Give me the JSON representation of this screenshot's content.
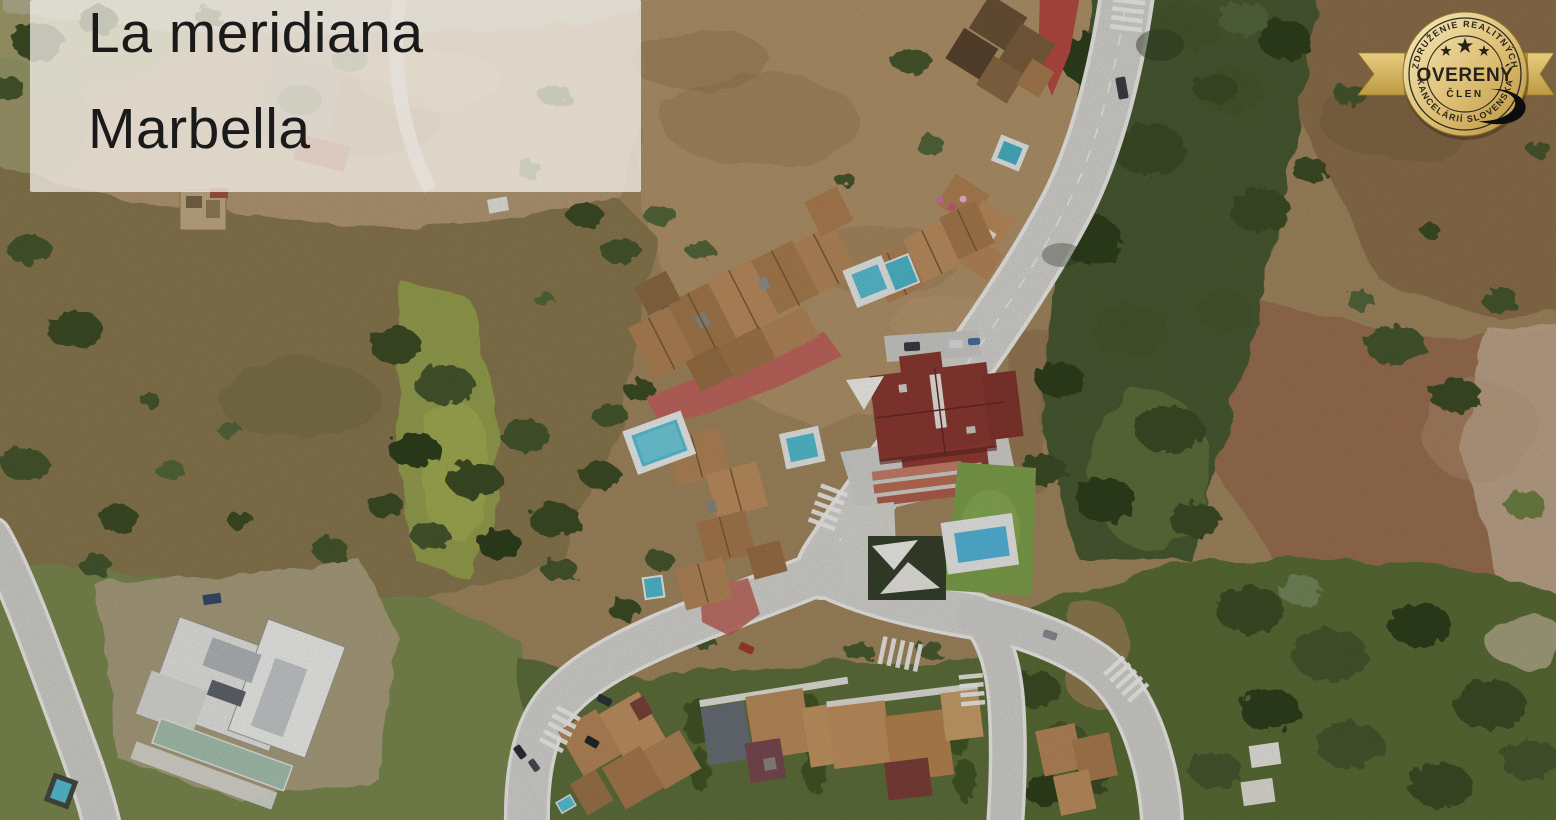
{
  "title": {
    "line1": "La meridiana",
    "line2": "Marbella"
  },
  "badge": {
    "arc_top": "ZDRUŽENIE REALITNÝCH",
    "main": "OVERENÝ",
    "sub": "ČLEN",
    "arc_bottom": "KANCELÁRIÍ SLOVENSKA",
    "stars": 3,
    "colors": {
      "gold_light": "#f6ecc0",
      "gold_dark": "#b8933f",
      "ribbon": "#d9b763",
      "text": "#26221a"
    }
  },
  "map": {
    "type": "satellite-aerial",
    "location": "La Meridiana residential area, Marbella",
    "palette": {
      "dry_terrain": "#b29066",
      "scrubland": "#8a7950",
      "grass": "#98a24f",
      "forest": "#44552e",
      "road": "#d7d6d2",
      "roof_terracotta": "#b5875a",
      "roof_red": "#8c3932",
      "pool_water": "#58c3d8",
      "paved_red": "#c2675e"
    },
    "features": [
      "winding residential roads with white curbs",
      "terracotta-roof townhouse clusters",
      "large red-roof mansion with sail shades and pool",
      "white modern villa under construction",
      "eight swimming pools",
      "pedestrian crosswalks",
      "red paved promenade",
      "dense tree belt and dry scrubland",
      "parked cars"
    ]
  }
}
